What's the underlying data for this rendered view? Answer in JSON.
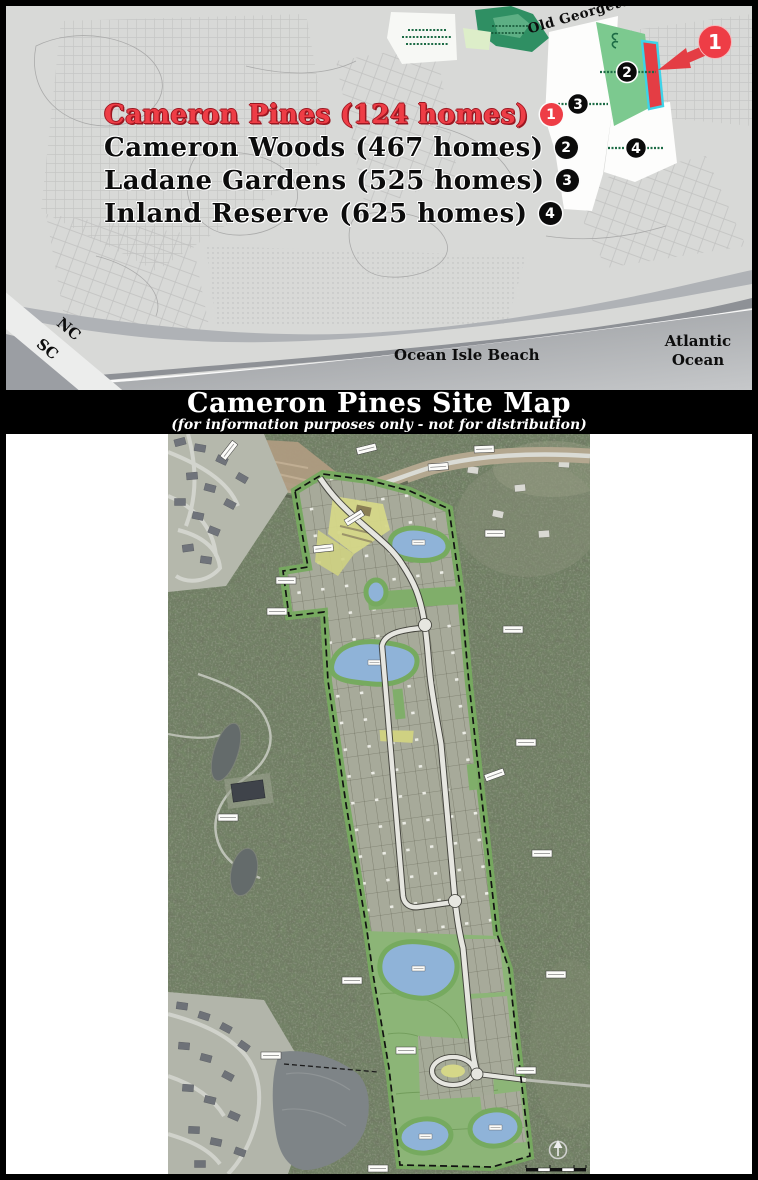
{
  "overview_map": {
    "legend": {
      "items": [
        {
          "label": "Cameron Pines (124 homes)",
          "badge": "1",
          "highlight": true
        },
        {
          "label": "Cameron Woods (467 homes)",
          "badge": "2",
          "highlight": false
        },
        {
          "label": "Ladane Gardens (525 homes)",
          "badge": "3",
          "highlight": false
        },
        {
          "label": "Inland Reserve (625 homes)",
          "badge": "4",
          "highlight": false
        }
      ]
    },
    "labels": {
      "road": "Old Georgetown Rd SW",
      "town": "Ocean Isle Beach",
      "ocean": "Atlantic Ocean",
      "state_north": "NC",
      "state_south": "SC"
    },
    "callout": {
      "badge": "1"
    },
    "parcels": {
      "badge_2": "2",
      "badge_3": "3",
      "badge_4": "4"
    }
  },
  "banner": {
    "title": "Cameron Pines Site Map",
    "subtitle": "(for information purposes only - not for distribution)"
  },
  "icons": {
    "north_arrow": "north-arrow",
    "callout_arrow": "red-callout-arrow"
  },
  "colors": {
    "legend_red": "#ee3d46",
    "parcel_red": "#e43d44",
    "parcel_cyan_outline": "#3ed3e8",
    "parcel_green": "#7cc98f",
    "parcel_dark_green": "#2f8f63",
    "pond_blue": "#8fb3d8",
    "buffer_green": "#76aa5f",
    "amenity_yellow": "#d5d788",
    "banner_bg": "#000000"
  }
}
